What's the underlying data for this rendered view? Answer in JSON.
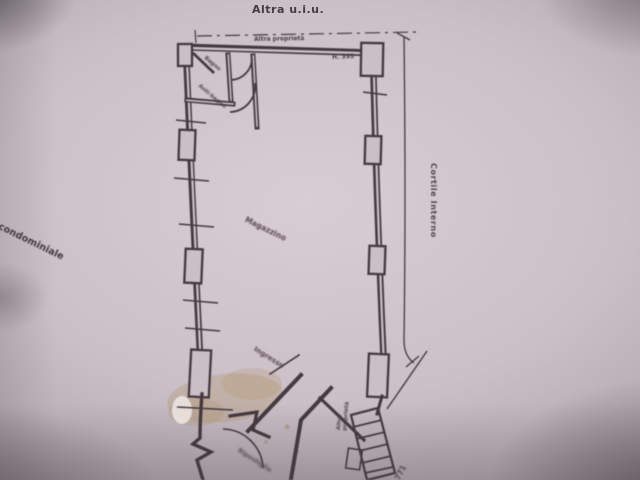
{
  "plan": {
    "title_top": "Altra u.i.u.",
    "boundary_top": "Altra proprietà",
    "height_note": "H. 395",
    "rooms": {
      "bagno": "Bagno",
      "antibagno": "Anti-bagno",
      "magazzino": "Magazzino",
      "ingresso": "Ingresso",
      "ripostiglio": "Ripostiglio"
    },
    "neighbor_right_l1": "Altra",
    "neighbor_right_l2": "proprietà",
    "courtyard_right": "Cortile Interno",
    "courtyard_left": "a condominiale",
    "bottom_right_number": "771"
  },
  "colors": {
    "ink": "#43393f",
    "paper": "#cbc0c7",
    "stain": "#a8854f"
  }
}
